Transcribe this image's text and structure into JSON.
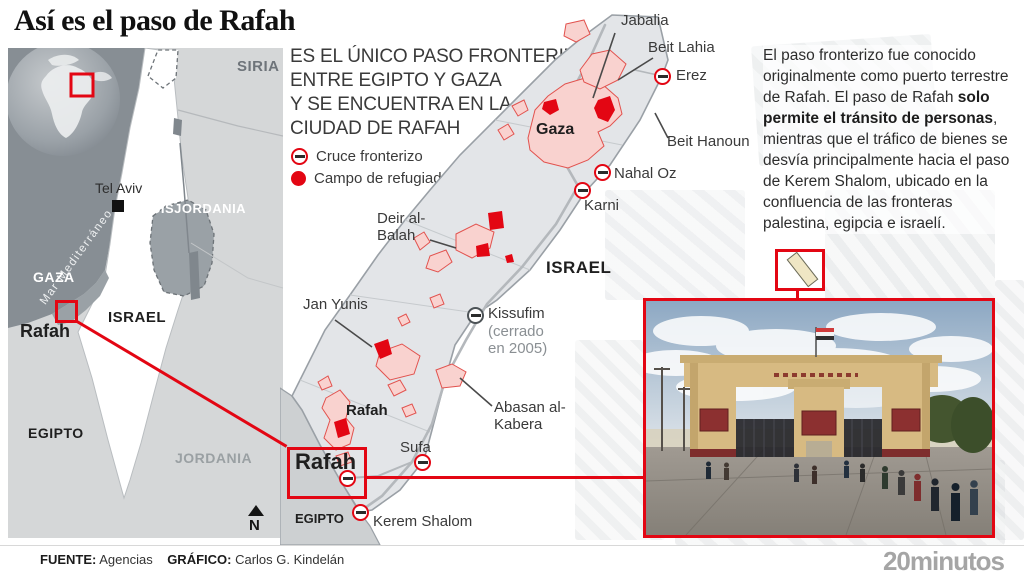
{
  "title": "Así es el paso de Rafah",
  "intro": {
    "lines": [
      "ES EL ÚNICO PASO FRONTERIZO",
      "ENTRE EGIPTO Y GAZA",
      "Y SE ENCUENTRA EN LA",
      "CIUDAD DE RAFAH"
    ]
  },
  "legend": {
    "crossing": "Cruce fronterizo",
    "camp": "Campo de refugiados"
  },
  "colors": {
    "accent_red": "#e30613",
    "urban_pink": "#f9d2cf",
    "sea_gray": "#878e94",
    "land_light": "#d5d7d8",
    "land_mid": "#9aa1a6",
    "strip_fill": "#e3e5e8"
  },
  "locator_map": {
    "sea": "Mar Mediterráneo",
    "siria": "SIRIA",
    "cisjordania": "CISJORDANIA",
    "tel_aviv": "Tel Aviv",
    "gaza": "GAZA",
    "rafah": "Rafah",
    "israel": "ISRAEL",
    "egipto": "EGIPTO",
    "jordania": "JORDANIA",
    "compass": "N"
  },
  "gaza_map": {
    "jabalia": "Jabalia",
    "beit_lahia": "Beit Lahia",
    "erez": "Erez",
    "beit_hanoun": "Beit Hanoun",
    "gaza": "Gaza",
    "nahal_oz": "Nahal Oz",
    "karni": "Karni",
    "deir_al_balah": "Deir al-Balah",
    "israel": "ISRAEL",
    "kissufim": "Kissufim",
    "kissufim_note": "(cerrado en 2005)",
    "jan_yunis": "Jan Yunis",
    "abasan": "Abasan al-Kabera",
    "rafah_town": "Rafah",
    "sufa": "Sufa",
    "rafah_crossing": "Rafah",
    "kerem_shalom": "Kerem Shalom",
    "egipto": "EGIPTO"
  },
  "description": {
    "part1": "El paso fronterizo fue conocido originalmente como puerto terrestre de Rafah. El paso de Rafah ",
    "bold": "solo permite el tránsito de personas",
    "part2": ", mientras que el tráfico de bienes se desvía principalmente hacia el paso de Kerem Shalom, ubicado en la confluencia de las fronteras palestina, egipcia e israelí."
  },
  "footer": {
    "source_label": "FUENTE:",
    "source": "Agencias",
    "credit_label": "GRÁFICO:",
    "credit": "Carlos G. Kindelán",
    "brand": "20minutos"
  }
}
